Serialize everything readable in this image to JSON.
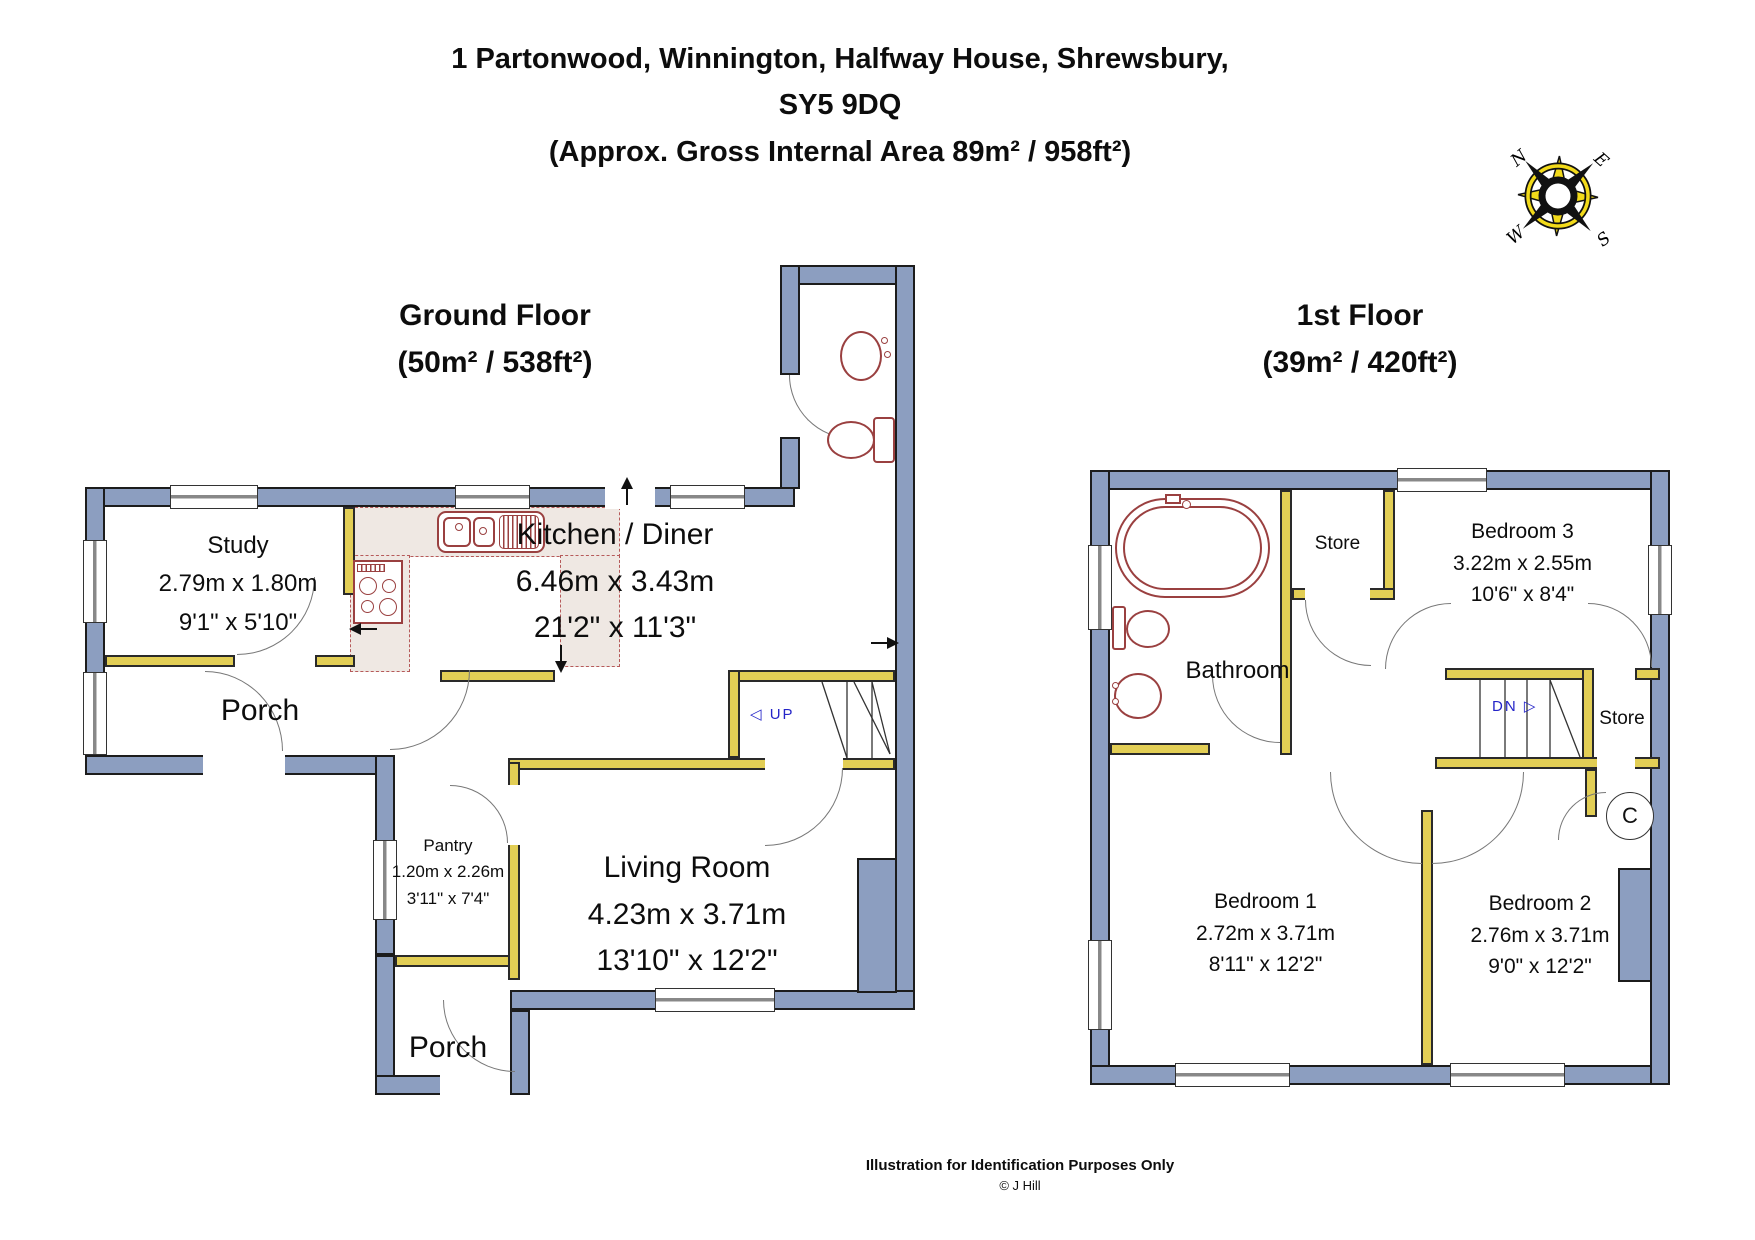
{
  "title": {
    "line1": "1 Partonwood, Winnington, Halfway House, Shrewsbury,",
    "line2": "SY5 9DQ",
    "line3": "(Approx. Gross Internal Area 89m² / 958ft²)"
  },
  "compass": {
    "n": "N",
    "e": "E",
    "s": "S",
    "w": "W"
  },
  "ground_floor": {
    "heading": "Ground Floor",
    "area_label": "(50m² / 538ft²)",
    "stairs": {
      "label": "UP",
      "icon": "◁"
    },
    "rooms": {
      "study": {
        "name": "Study",
        "metric": "2.79m x 1.80m",
        "imperial": "9'1\" x 5'10\""
      },
      "kitchen": {
        "name": "Kitchen / Diner",
        "metric": "6.46m x 3.43m",
        "imperial": "21'2\" x 11'3\""
      },
      "porch_front": {
        "name": "Porch"
      },
      "pantry": {
        "name": "Pantry",
        "metric": "1.20m x 2.26m",
        "imperial": "3'11\" x 7'4\""
      },
      "living": {
        "name": "Living Room",
        "metric": "4.23m x 3.71m",
        "imperial": "13'10\" x 12'2\""
      },
      "porch_rear": {
        "name": "Porch"
      }
    }
  },
  "first_floor": {
    "heading": "1st Floor",
    "area_label": "(39m² / 420ft²)",
    "stairs": {
      "label": "DN",
      "icon": "▷"
    },
    "cupboard_label": "C",
    "rooms": {
      "bathroom": {
        "name": "Bathroom"
      },
      "store_top": {
        "name": "Store"
      },
      "store_right": {
        "name": "Store"
      },
      "bedroom3": {
        "name": "Bedroom 3",
        "metric": "3.22m x 2.55m",
        "imperial": "10'6\" x 8'4\""
      },
      "bedroom1": {
        "name": "Bedroom 1",
        "metric": "2.72m x 3.71m",
        "imperial": "8'11\" x 12'2\""
      },
      "bedroom2": {
        "name": "Bedroom 2",
        "metric": "2.76m x 3.71m",
        "imperial": "9'0\" x 12'2\""
      }
    }
  },
  "footer": {
    "line1": "Illustration for Identification Purposes Only",
    "line2": "© J Hill"
  },
  "colors": {
    "exterior_wall": "#8C9EC0",
    "interior_wall": "#E2CE55",
    "fixture_outline": "#9A4040",
    "counter_fill": "#EFE8E3",
    "stairs_text": "#2424C8",
    "compass_yellow": "#F2DA1A"
  }
}
